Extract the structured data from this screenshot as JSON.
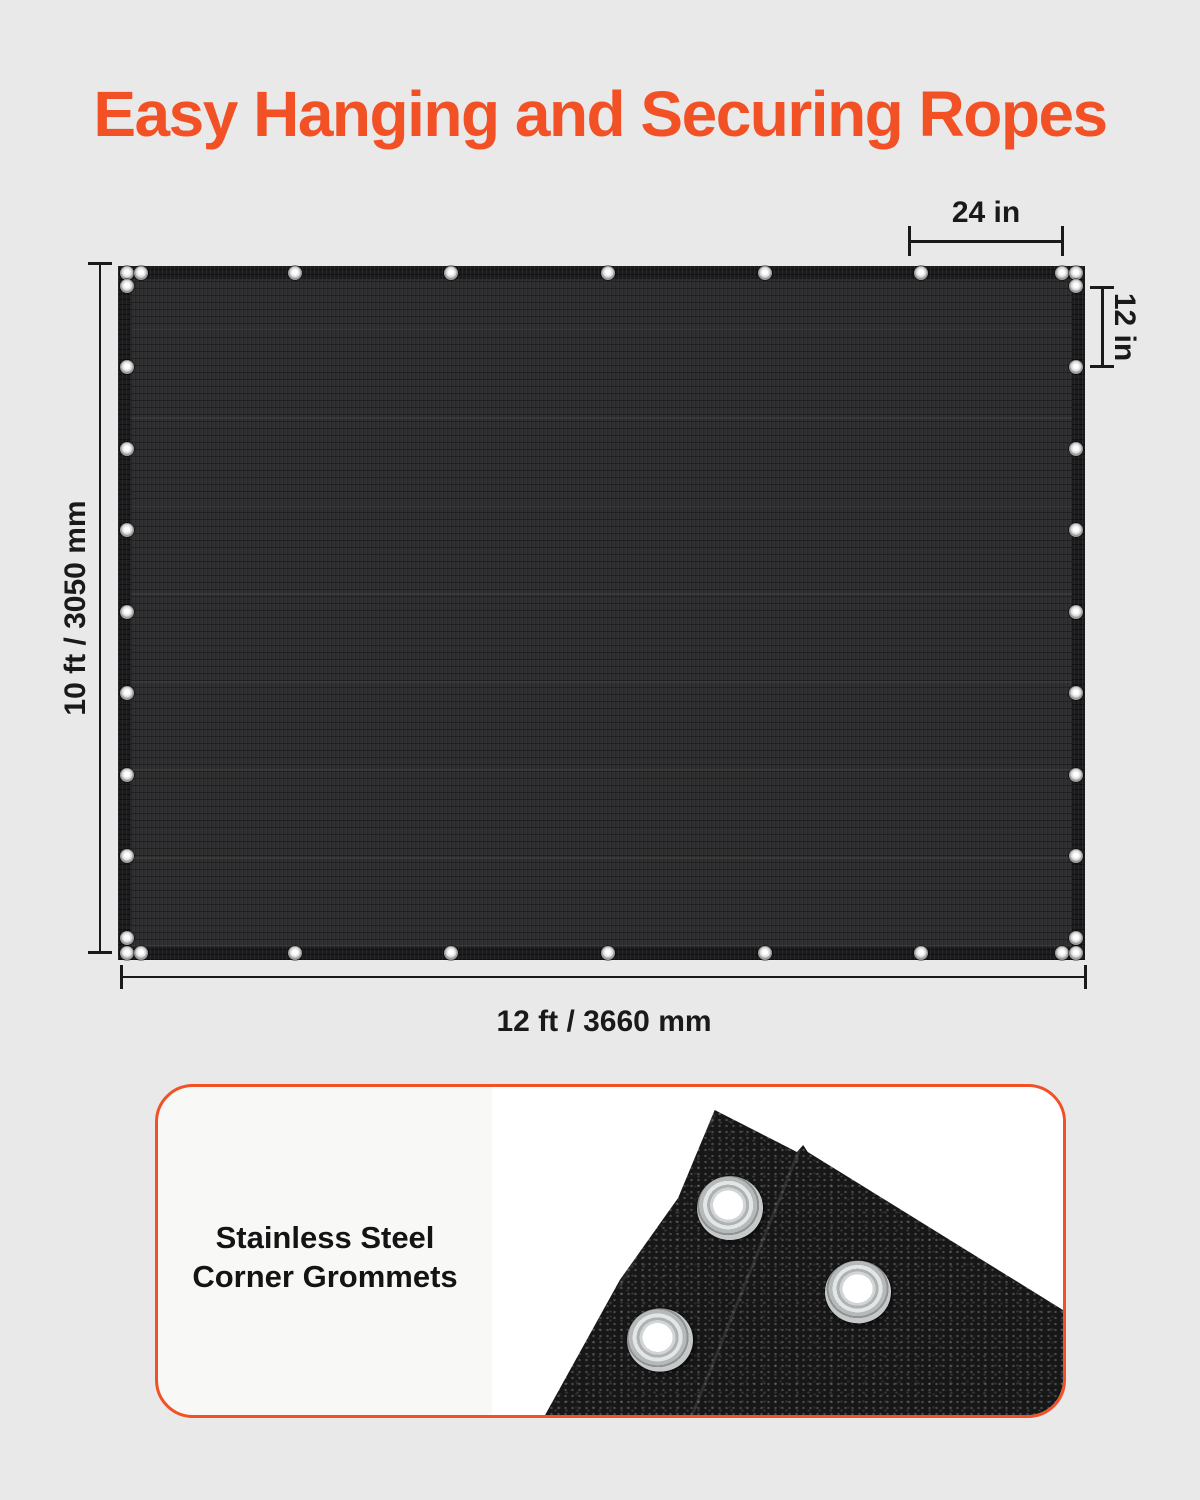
{
  "title": {
    "text": "Easy Hanging and Securing Ropes"
  },
  "dimensions": {
    "tarp_width": "12 ft / 3660 mm",
    "tarp_height": "10 ft / 3050 mm",
    "grommet_spacing_top": "24 in",
    "grommet_spacing_side": "12 in"
  },
  "card": {
    "caption_line1": "Stainless Steel",
    "caption_line2": "Corner Grommets"
  },
  "colors": {
    "accent": "#F25126",
    "dim_color": "#1A1A1A",
    "page_bg": "#E9E9E9",
    "tarp_fabric": "#2E2E30",
    "tarp_border": "#1B1B1D",
    "card_bg": "#F8F8F6",
    "photo_bg": "#FFFFFF",
    "photo_fabric": "#171717"
  }
}
